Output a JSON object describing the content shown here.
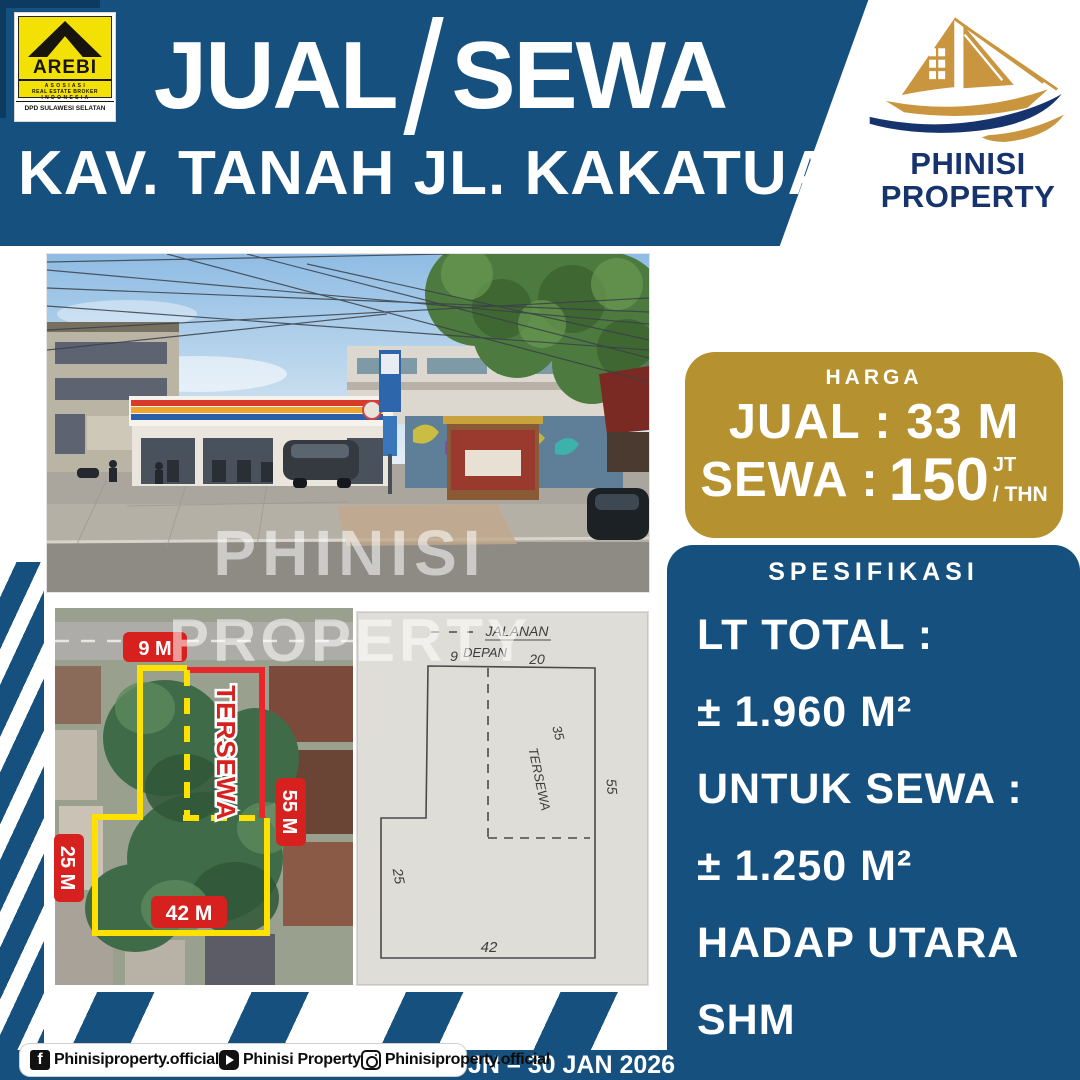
{
  "header": {
    "jual": "JUAL",
    "sewa": "SEWA",
    "subtitle": "KAV. TANAH JL. KAKATUA"
  },
  "arebi": {
    "name": "AREBI",
    "line1": "A S O S I A S I",
    "line2": "REAL ESTATE BROKER",
    "line3": "I N D O N E S I A",
    "region": "DPD SULAWESI SELATAN"
  },
  "brand": {
    "line1": "PHINISI",
    "line2": "PROPERTY"
  },
  "price": {
    "label": "HARGA",
    "jual": "JUAL : 33 M",
    "sewa_prefix": "SEWA :",
    "sewa_value": "150",
    "sewa_sup": "JT",
    "sewa_per": "/ THN"
  },
  "specs": {
    "label": "SPESIFIKASI",
    "lines": [
      "LT TOTAL :",
      "± 1.960 M²",
      "UNTUK SEWA :",
      "± 1.250 M²",
      "HADAP UTARA",
      "SHM"
    ]
  },
  "watermarks": {
    "photo": "PHINISI",
    "plans": "PROPERTY"
  },
  "satellite_labels": {
    "front": "9 M",
    "tersewa": "TERSEWA",
    "right": "55 M",
    "left": "25 M",
    "bottom": "42 M"
  },
  "sketch_labels": {
    "street": "JALANAN",
    "front": "DEPAN",
    "front_width": "9",
    "tersewa_width": "20",
    "inner_depth": "35",
    "tersewa": "TERSEWA",
    "right_depth": "55",
    "left_depth": "25",
    "bottom_width": "42"
  },
  "footer": {
    "facebook": "Phinisiproperty.official",
    "youtube": "Phinisi Property",
    "instagram": "Phinisiproperty.official",
    "date": "JN – 30 JAN 2026"
  },
  "colors": {
    "navy": "#15507E",
    "navy_dark": "#0D3A60",
    "gold": "#B5912F",
    "label_red": "#D7211E",
    "outline_yellow": "#FFE100",
    "logo_navy": "#16336E",
    "logo_gold": "#C9963F"
  }
}
